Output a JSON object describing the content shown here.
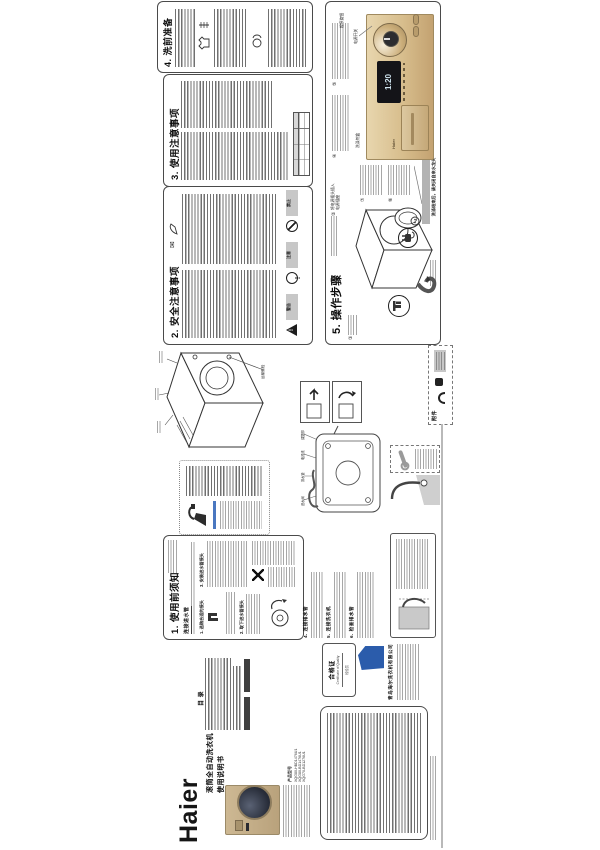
{
  "cover": {
    "brand": "Haier",
    "title_line1": "滚筒全自动洗衣机",
    "title_line2": "使用说明书",
    "model_label": "产品型号",
    "model1": "XQG80-HBD1476U1",
    "model2": "XQG80-BD1476U1",
    "model3": "XQG70-BD1276U1"
  },
  "toc": {
    "header": "目 录"
  },
  "sec1": {
    "title": "1. 使用前须知",
    "sub": "连接进水管",
    "step1": "1. 选购合适的接头",
    "step2": "2. 取下进水管接头",
    "step3": "3. 安装进水管接头"
  },
  "sec2": {
    "title": "2. 安全注意事项",
    "warn": "警告",
    "note": "注意",
    "ban": "禁止"
  },
  "sec3": {
    "title": "3. 使用注意事项"
  },
  "sec4": {
    "title": "4. 洗前准备"
  },
  "sec5": {
    "title": "5. 操作步骤",
    "badge": "洗涤结束后，请关闭自来水龙头",
    "plug_note_1": "将电源插头插入",
    "plug_note_2": "电源插座",
    "label_power": "电源开关",
    "label_knob": "程序旋钮",
    "label_drawer": "洗涤剂盒",
    "display": "1:20",
    "n1": "①",
    "n2": "②",
    "n3": "③",
    "n4": "④",
    "n5": "⑤",
    "n6": "⑥",
    "n7": "⑦",
    "n8": "⑧"
  },
  "install": {
    "step4": "4. 连接排水管",
    "step5": "5. 连接洗衣机",
    "step6": "6. 检查排水管",
    "bolt_label": "运输螺栓",
    "back_label1": "进水阀",
    "back_label2": "排水管",
    "back_label3": "电源线",
    "back_label4": "调整脚"
  },
  "bottom": {
    "cert_title": "合格证",
    "cert_sub": "Certificate of Quality",
    "cert_stamp": "检验员",
    "company": "青岛海尔洗衣机有限公司"
  },
  "accessories": {
    "label": "附件"
  }
}
